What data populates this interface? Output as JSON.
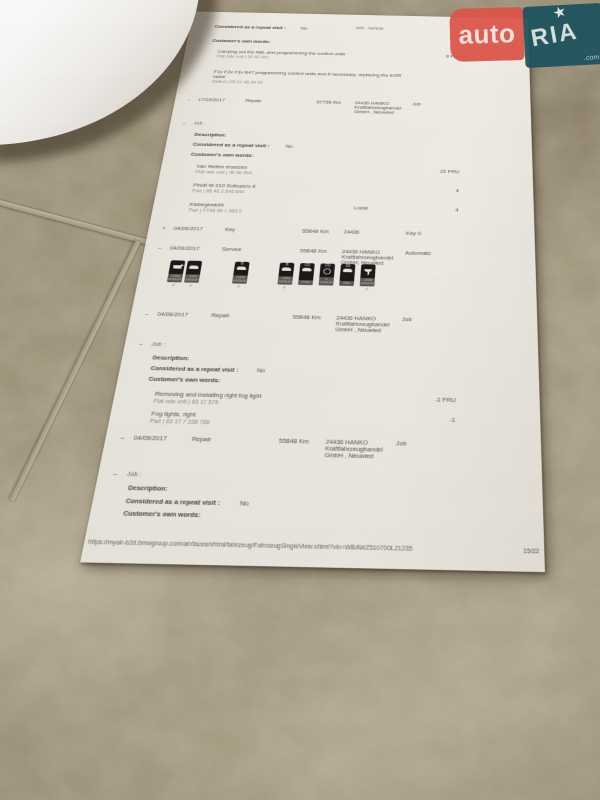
{
  "watermark": {
    "auto": "auto",
    "ria": "RIA",
    "star": "★",
    "tld": ".com",
    "red": "#e2554b",
    "teal": "#1e5663"
  },
  "doc": {
    "header": "AIR - Vehicle",
    "labels": {
      "description": "Description:",
      "repeat": "Considered as a repeat visit :",
      "no": "No",
      "own": "Customer's own words:",
      "job": "Job :",
      "local": "Local"
    },
    "intro": {
      "item1": {
        "title": "Carrying out the ABL and programming the control units",
        "sub": "Flat rate unit | 00 63 941",
        "value": "8 FRU"
      },
      "item2": {
        "title": "F1x F2x F3x B47 programming control units and if necessary, replacing the EGR valve",
        "sub": "Defect | 00 11 45 04 00"
      }
    },
    "entries": [
      {
        "bullet": "–",
        "date": "17/10/2017",
        "kind": "Repair",
        "km": "57755 Km",
        "dealer": "24436 HANKO\nKraftfahrzeughandel\nGmbH , Neuwied",
        "tag": "Job"
      },
      {
        "bullet": "+",
        "date": "04/09/2017",
        "kind": "Key",
        "km": "55848 Km",
        "dealer": "24436",
        "tag": "Key 0"
      },
      {
        "bullet": "–",
        "date": "04/09/2017",
        "kind": "Service",
        "km": "55848 Km",
        "dealer": "24436 HANKO\nKraftfahrzeughandel\nGmbH, Neuwied",
        "tag": "Automatic"
      },
      {
        "bullet": "–",
        "date": "04/09/2017",
        "kind": "Repair",
        "km": "55848 Km",
        "dealer": "24436 HANKO\nKraftfahrzeughandel\nGmbH , Neuwied",
        "tag": "Job"
      },
      {
        "bullet": "–",
        "date": "04/09/2017",
        "kind": "Repair",
        "km": "55848 Km",
        "dealer": "24436 HANKO\nKraftfahrzeughandel\nGmbH , Neuwied",
        "tag": "Job"
      }
    ],
    "repair1_items": [
      {
        "title": "Vier Reifen ersetzen",
        "sub": "Flat rate unit | 36 00 004",
        "value": "22 FRU"
      },
      {
        "title": "Pirelli W 210 Sottozero II",
        "sub": "Part | 85 45 2 546 694",
        "value": "4"
      },
      {
        "title": "Klebegewicht",
        "sub": "Part | FT93 99 1 983 0",
        "mid": "Local",
        "value": "4"
      }
    ],
    "repair2_items": [
      {
        "title": "Removing and installing right fog light",
        "sub": "Flat rate unit | 63 17 575",
        "value": "-1 FRU"
      },
      {
        "title": "Fog lights, right",
        "sub": "Part | 63 17 7 238 788",
        "value": "-1"
      }
    ],
    "stamps": [
      {
        "name": "engine-oil",
        "glyph": "oilcan",
        "mark": "",
        "line1": "+1400",
        "line2": "09/2018",
        "check": "✓"
      },
      {
        "name": "vehicle-check",
        "glyph": "car",
        "mark": "",
        "line1": "+1400",
        "line2": "04/2018",
        "check": "✓"
      },
      {
        "name": "front-brake",
        "glyph": "car",
        "mark": "B",
        "line1": "+1400",
        "line2": "09/2018",
        "check": "✓"
      },
      {
        "name": "rear-brake",
        "glyph": "car",
        "mark": "B",
        "line1": "+1400",
        "line2": "09/2018",
        "check": "✓"
      },
      {
        "name": "wheel-service",
        "glyph": "car",
        "mark": "(O)",
        "line1": "21920",
        "line2": "",
        "check": ""
      },
      {
        "name": "steering-check",
        "glyph": "steer",
        "mark": "(O)",
        "line1": "0",
        "line2": "09/2018",
        "check": ""
      },
      {
        "name": "brake-fluid",
        "glyph": "car",
        "mark": "|O|",
        "line1": "8/00",
        "line2": "",
        "check": ""
      },
      {
        "name": "statutory-inspection",
        "glyph": "goblet",
        "mark": "",
        "line1": "+1400",
        "line2": "09/2018",
        "check": "✓"
      }
    ],
    "footer": {
      "url": "https://myair-b2d.bmwgroup.com/air/faces/xhtml/fahrzeug/FahrzeugSingleView.xhtml?vin=WBAWZ510700L21235",
      "page": "15/22"
    }
  }
}
